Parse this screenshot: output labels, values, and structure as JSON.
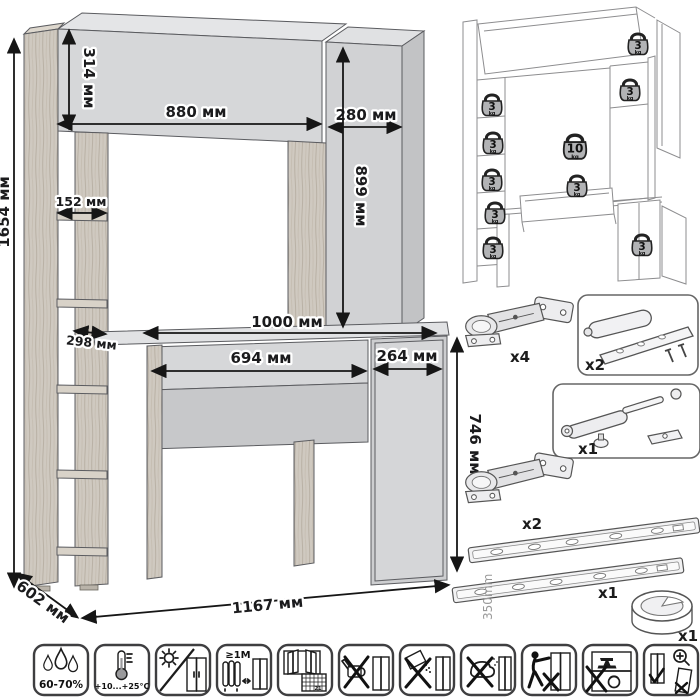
{
  "main_drawing": {
    "unit": "мм",
    "dimensions": {
      "total_height": "1654 мм",
      "hutch_height": "314 мм",
      "hutch_width": "880 мм",
      "right_column_width": "280 мм",
      "right_column_height": "899 мм",
      "shelf_width": "152 мм",
      "shelf_depth": "298 мм",
      "desktop_width": "1000 мм",
      "drawer_width": "694 мм",
      "door_width": "264 мм",
      "desk_height": "746 мм",
      "depth": "602 мм",
      "total_width": "1167 мм"
    },
    "colors": {
      "panel_front": "#d6d7d9",
      "panel_top": "#e4e5e7",
      "panel_side": "#c2c3c5",
      "wood": "#cfc9c0",
      "dimension_line": "#161616"
    }
  },
  "load_diagram": {
    "badges": [
      {
        "id": "top-right-shelf",
        "value": "3",
        "unit": "kg"
      },
      {
        "id": "right-shelf",
        "value": "3",
        "unit": "kg"
      },
      {
        "id": "left-shelf-1",
        "value": "3",
        "unit": "kg"
      },
      {
        "id": "left-shelf-2",
        "value": "3",
        "unit": "kg"
      },
      {
        "id": "desktop",
        "value": "10",
        "unit": "kg"
      },
      {
        "id": "left-shelf-3",
        "value": "3",
        "unit": "kg"
      },
      {
        "id": "drawer",
        "value": "3",
        "unit": "kg"
      },
      {
        "id": "left-shelf-4",
        "value": "3",
        "unit": "kg"
      },
      {
        "id": "left-shelf-5",
        "value": "3",
        "unit": "kg"
      },
      {
        "id": "bottom-right-cabinet",
        "value": "3",
        "unit": "kg"
      }
    ]
  },
  "hardware": {
    "hinge_top": {
      "icon": "concealed-hinge",
      "qty": "x4"
    },
    "damper": {
      "icon": "door-damper",
      "qty": "x2"
    },
    "gas_lift": {
      "icon": "gas-lift-strut",
      "qty": "x1"
    },
    "hinge_bottom": {
      "icon": "concealed-hinge",
      "qty": "x2"
    },
    "drawer_slides": {
      "icon": "drawer-slides",
      "qty": "x1",
      "length": "350mm"
    },
    "grommet": {
      "icon": "cable-grommet",
      "qty": "x1"
    }
  },
  "care_icons": [
    {
      "name": "humidity",
      "label": "60-70%"
    },
    {
      "name": "temperature-range",
      "label": "+10...+25°C"
    },
    {
      "name": "no-direct-sunlight",
      "label": ""
    },
    {
      "name": "keep-1m-from-heat",
      "label": "≥1M"
    },
    {
      "name": "ventilation-acclimatize",
      "label": "21"
    },
    {
      "name": "no-wet-cleaning",
      "label": ""
    },
    {
      "name": "no-abrasive-cleaners",
      "label": ""
    },
    {
      "name": "no-solvents",
      "label": ""
    },
    {
      "name": "do-not-drag",
      "label": ""
    },
    {
      "name": "do-not-overload",
      "label": ""
    },
    {
      "name": "check-stability-anchoring",
      "label": ""
    }
  ]
}
